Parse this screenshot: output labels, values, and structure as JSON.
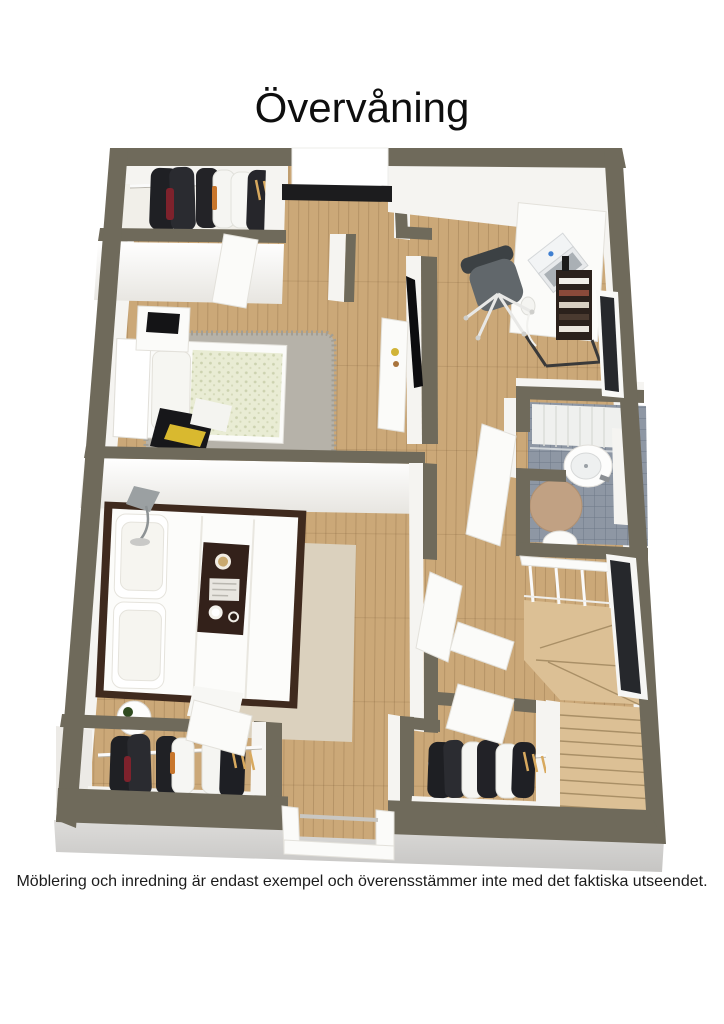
{
  "page": {
    "title": "Övervåning",
    "disclaimer": "Möblering och inredning är endast exempel och överensstämmer inte med det faktiska utseendet.",
    "background": "#ffffff"
  },
  "floor_plan": {
    "view": "3d-overhead-dollhouse-render",
    "floor_label": "Övervåning",
    "rooms": [
      "walk-in-closet-top",
      "small-bedroom",
      "hallway",
      "study",
      "bathroom",
      "master-bedroom",
      "closet-bottom-left",
      "closet-bottom-right",
      "staircase"
    ],
    "furniture": [
      "hanging-clothes",
      "single-bed",
      "nightstand",
      "gray-rug",
      "tv-partition",
      "media-cabinet",
      "desk",
      "laptop",
      "office-chair",
      "book-shelf",
      "wire-lamp",
      "shower",
      "sink",
      "toilet",
      "double-bed",
      "breakfast-tray",
      "floor-lamp",
      "side-table",
      "beige-rug",
      "stairs-railing",
      "winding-staircase",
      "balcony-door",
      "windows",
      "interior-doors"
    ],
    "colors": {
      "wall": "#6f6a5b",
      "wood": "#cba878",
      "wood_line": "#8a6a3f",
      "stair_wood": "#dcc095",
      "tile": "#8e97a4",
      "slab": "#d6d5d3",
      "rug_gray": "#b6b2a9",
      "rug_beige": "#dbd1be",
      "duvet": "#e9ecd4",
      "bed_frame": "#3f2a1e",
      "tray": "#33211a",
      "accent_red": "#7e222c",
      "hanger_tan": "#d8a95e",
      "glass_dark": "#26282c",
      "text": "#111111"
    }
  }
}
